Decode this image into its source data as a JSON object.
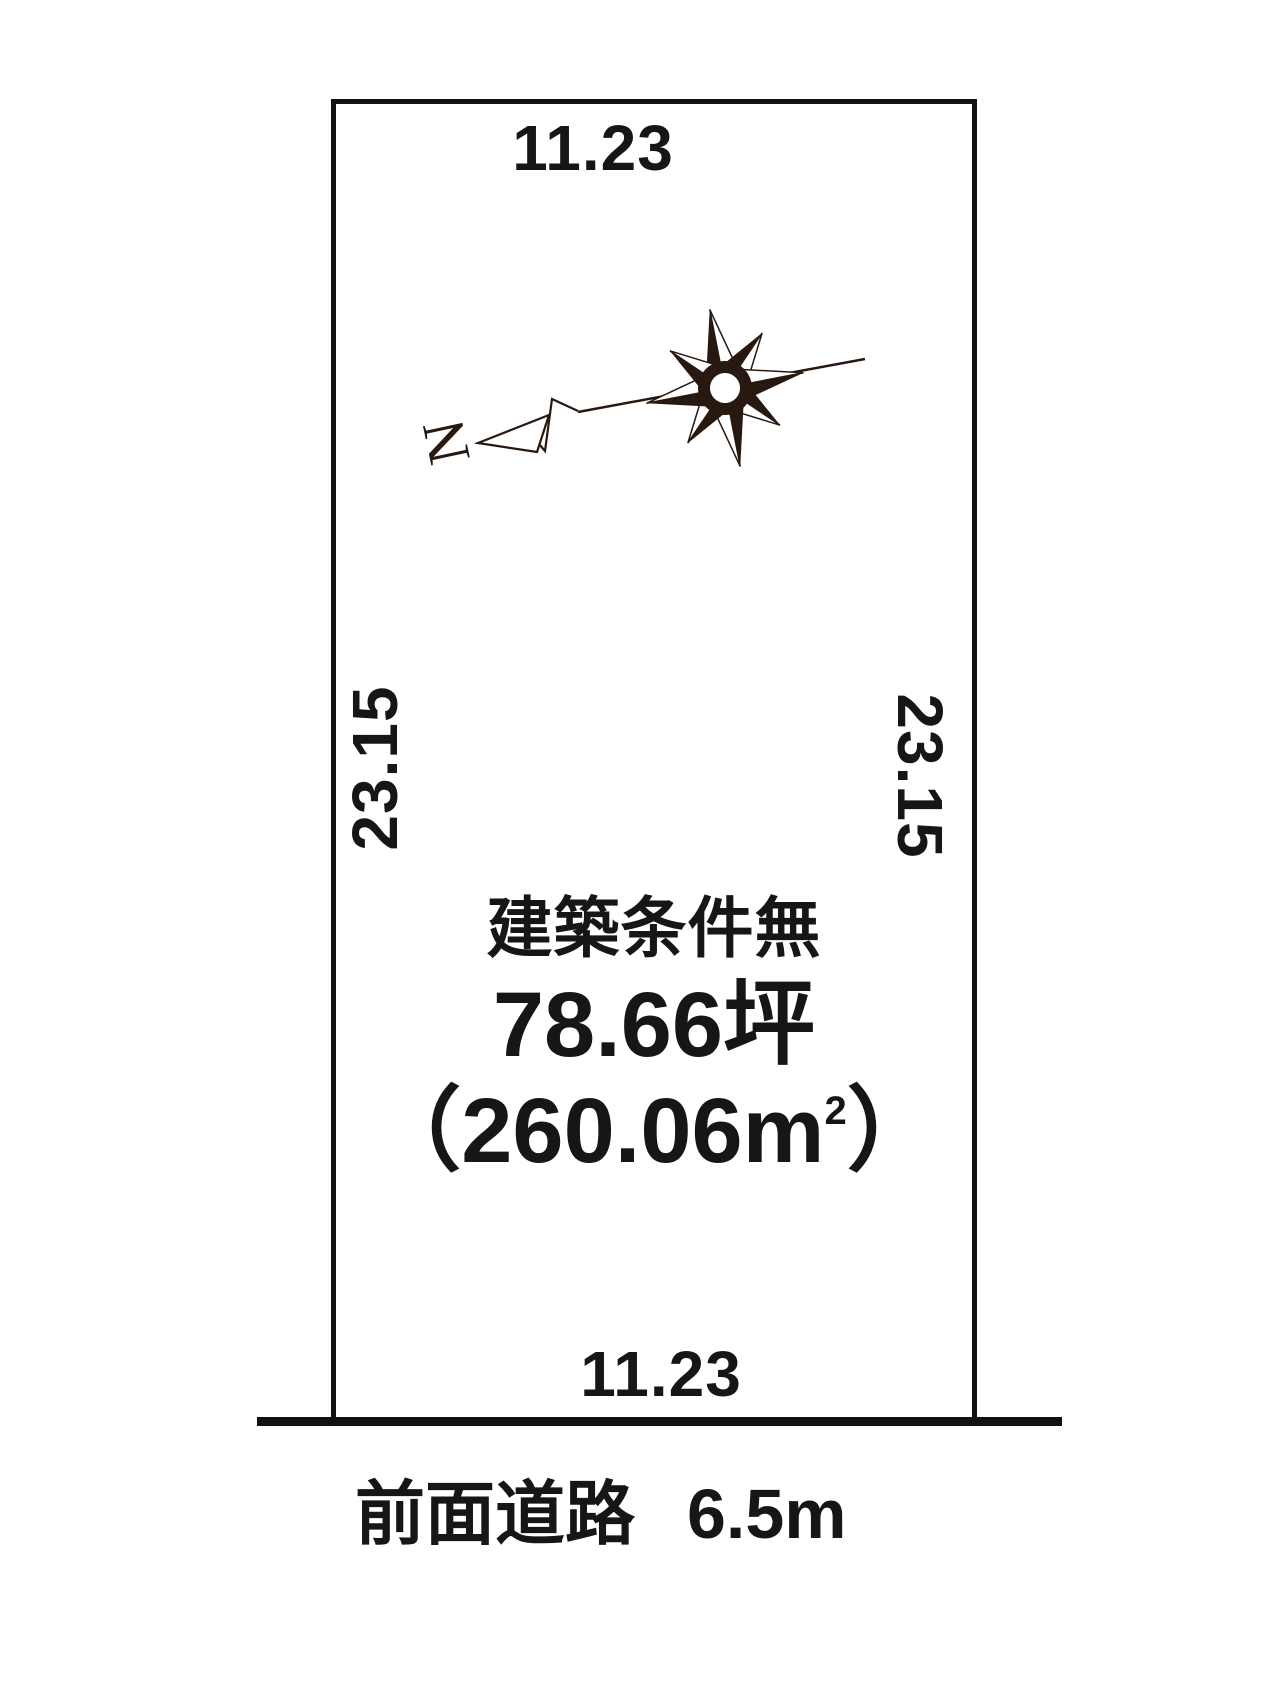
{
  "page": {
    "background": "#ffffff",
    "ink": "#161616",
    "compass_ink": "#27190f"
  },
  "plot": {
    "dim_top": "11.23",
    "dim_bottom": "11.23",
    "dim_left": "23.15",
    "dim_right": "23.15",
    "condition_label": "建築条件無",
    "area_tsubo": "78.66坪",
    "area_m2_prefix": "（260.06m",
    "area_m2_superscript": "2",
    "area_m2_suffix": "）"
  },
  "road": {
    "name": "前面道路",
    "width": "6.5m"
  },
  "compass": {
    "north_label": "N"
  }
}
